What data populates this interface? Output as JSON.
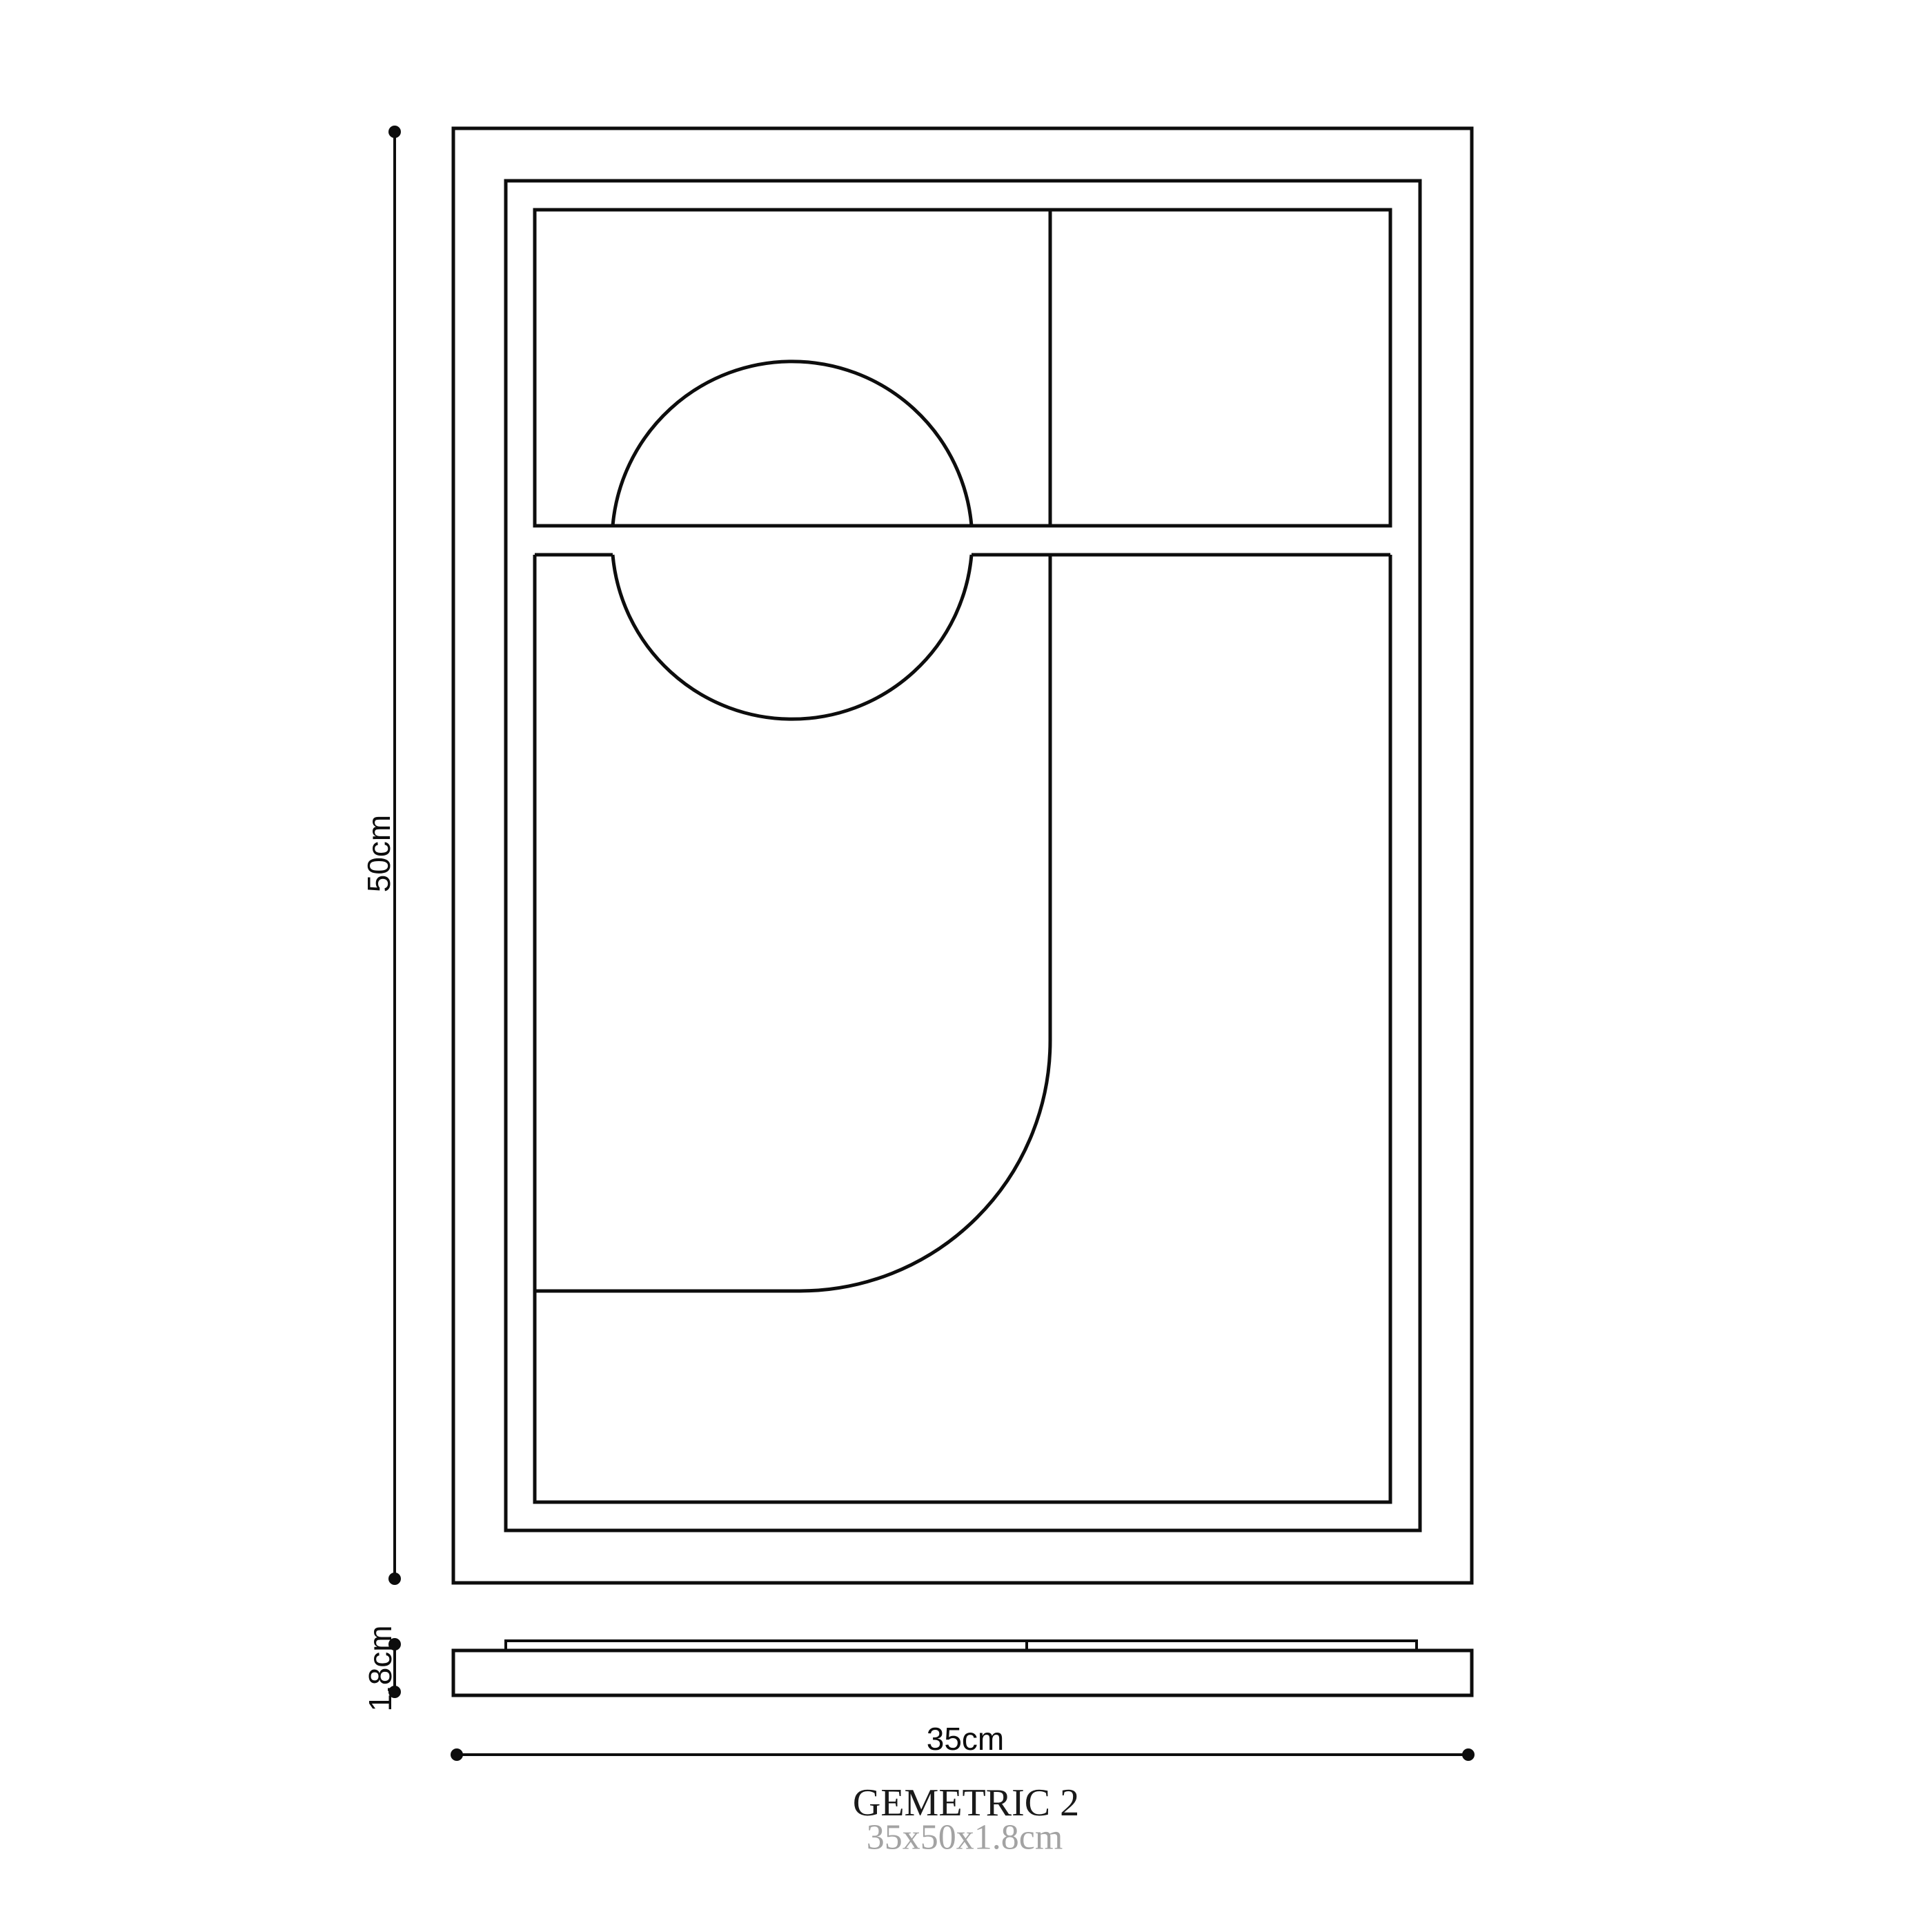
{
  "product": {
    "title": "GEMETRIC 2",
    "subtitle": "35x50x1.8cm"
  },
  "dimension_labels": {
    "height": "50cm",
    "width": "35cm",
    "depth": "1.8cm"
  },
  "colors": {
    "line": "#0d0d0d",
    "background": "#ffffff",
    "title": "#1a1a1a",
    "subtitle": "#a3a3a3"
  }
}
